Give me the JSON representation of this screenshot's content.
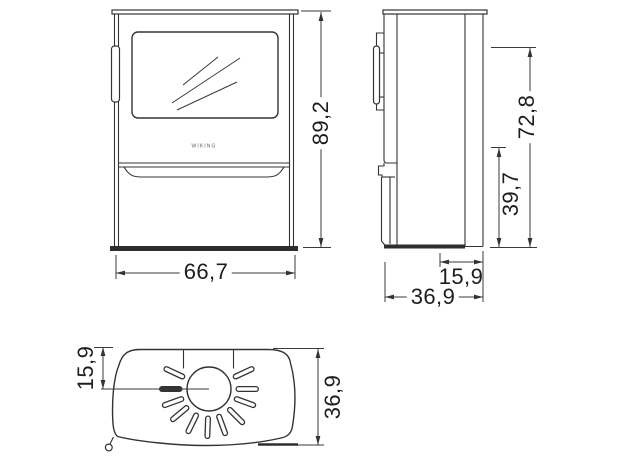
{
  "page": {
    "background": "#ffffff",
    "line_color": "#333333"
  },
  "drawing": {
    "brand_logo_text": "WIKING",
    "front_view": {
      "height": "89,2",
      "width": "66,7"
    },
    "side_view": {
      "upper_height": "72,8",
      "lower_height": "39,7",
      "flue_offset": "15,9",
      "depth": "36,9"
    },
    "top_view": {
      "flue_offset": "15,9",
      "depth": "36,9"
    }
  }
}
